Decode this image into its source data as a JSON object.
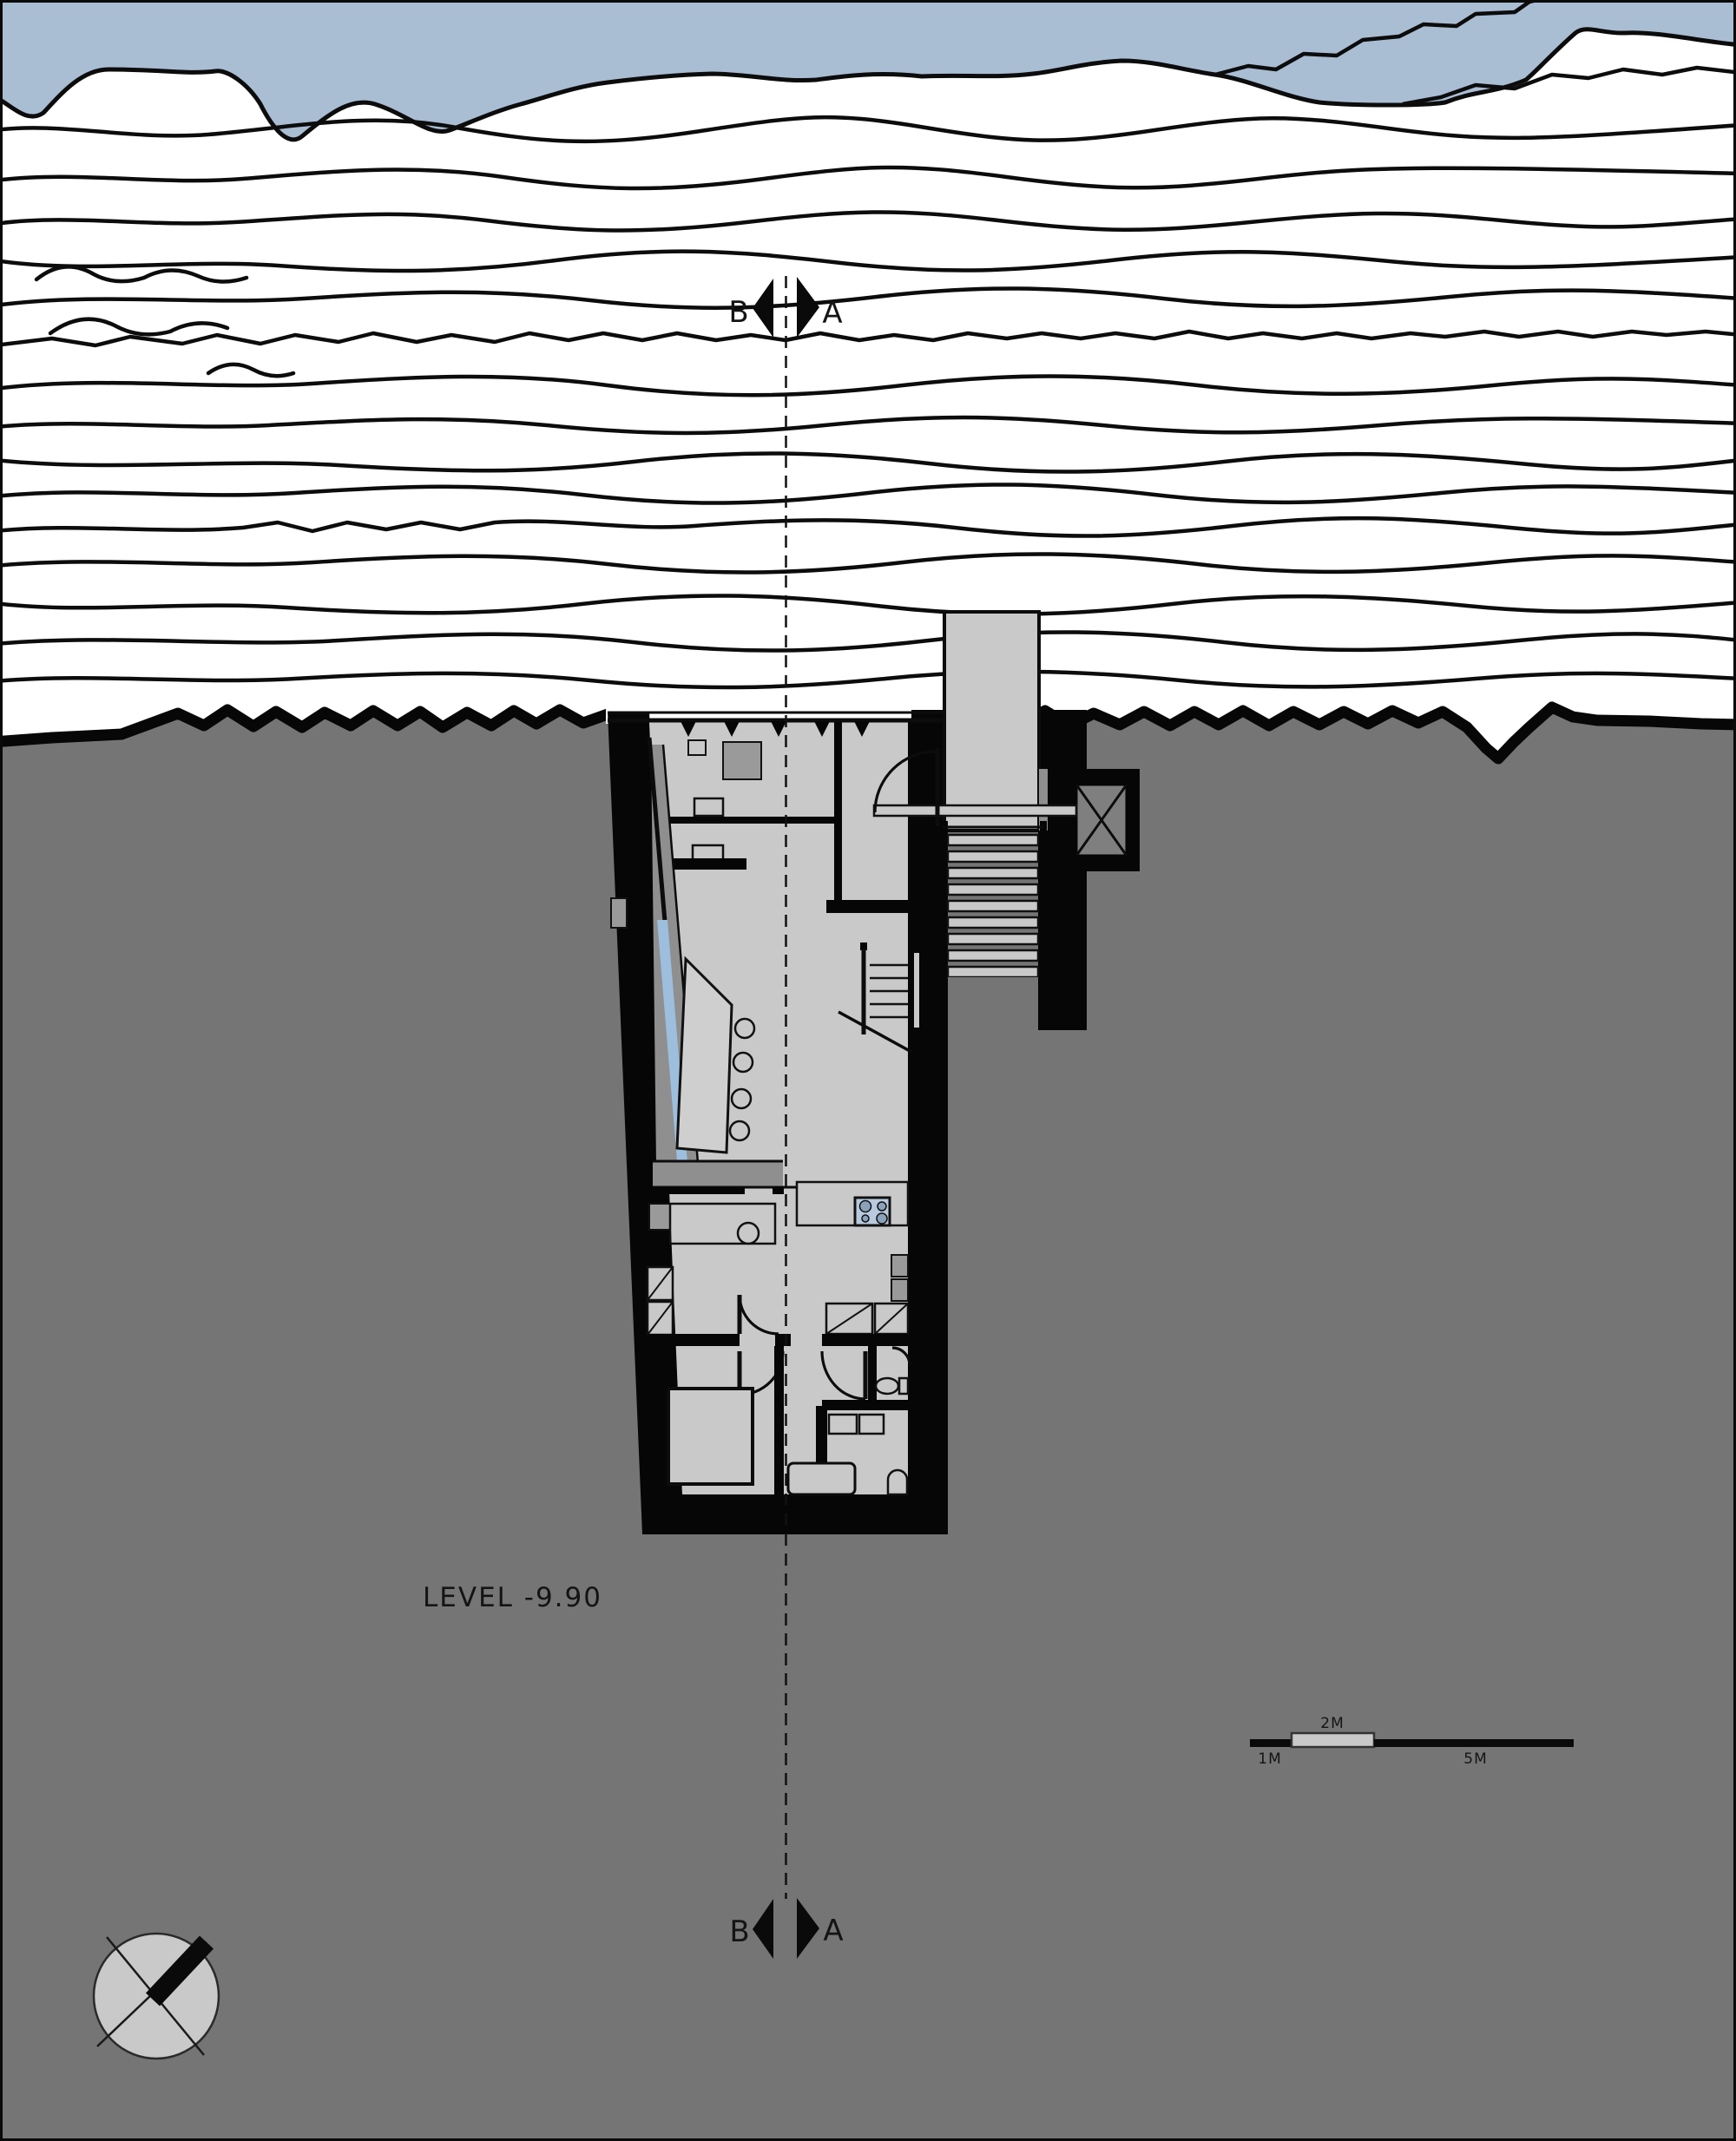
{
  "annotations": {
    "level_label": "LEVEL -9.90",
    "section_marker_top": {
      "left_label": "B",
      "right_label": "A"
    },
    "section_marker_bottom": {
      "left_label": "B",
      "right_label": "A"
    },
    "scale_bar": {
      "label_1m": "1M",
      "label_2m": "2M",
      "label_5m": "5M"
    }
  },
  "colors": {
    "water": "#a9bdd3",
    "terrain_ground": "#757575",
    "wall_black": "#060606",
    "floor": "#c9c9c9",
    "shadow_gray": "#8f8f8f",
    "window_glass": "#9dbedd",
    "cooktop": "#b9cade",
    "line": "#0c0c0c"
  }
}
